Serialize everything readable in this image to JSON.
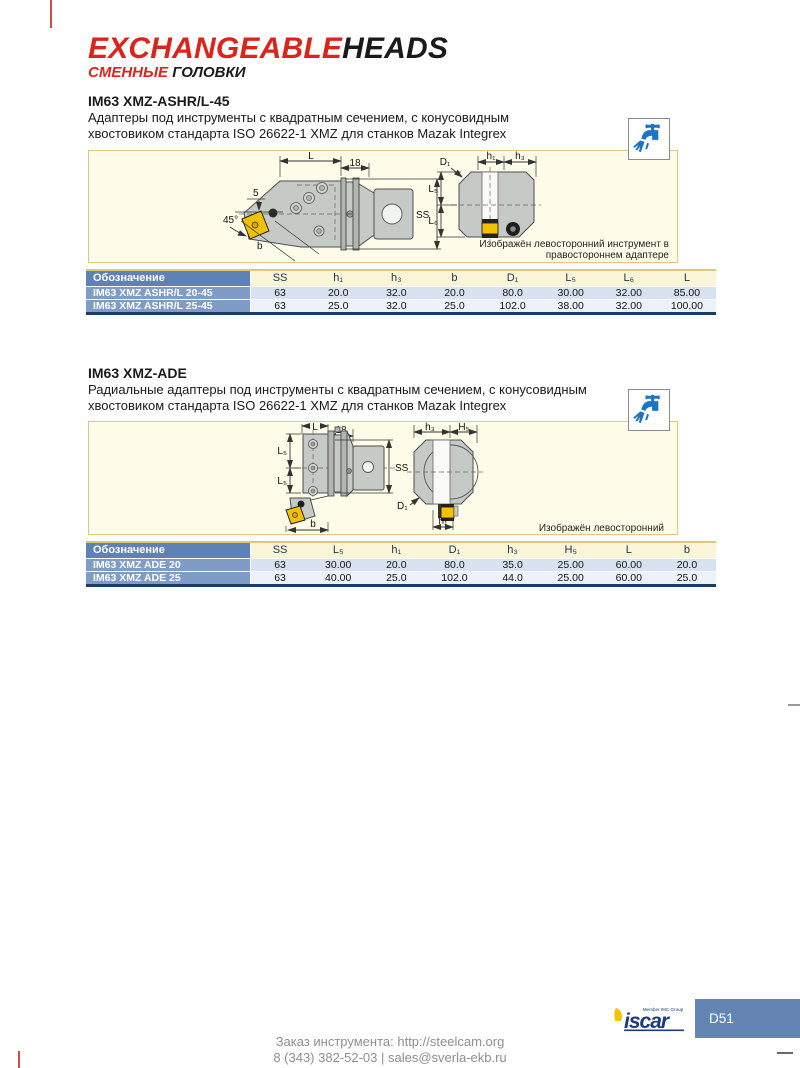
{
  "colors": {
    "accent_red": "#da251d",
    "table_header_blue": "#5d82b5",
    "row_name_blue": "#7e9cc6",
    "header_yellow": "#faf5d7",
    "row_light_blue": "#d9e2f0",
    "row_pale_blue": "#edf1f8",
    "navy_border": "#1e3a68",
    "panel_bg": "#fffdea",
    "panel_border": "#ddca7a",
    "coolant_icon_blue": "#1e74c4",
    "page_tab_blue": "#6484b4",
    "insert_yellow": "#f2c100"
  },
  "header": {
    "title_red": "EXCHANGEABLE",
    "title_black": "HEADS",
    "subtitle_red": "СМЕННЫЕ",
    "subtitle_black": "ГОЛОВКИ"
  },
  "sections": [
    {
      "title": "IM63 XMZ-ASHR/L-45",
      "desc1": "Адаптеры под инструменты с квадратным сечением, с конусовидным",
      "desc2": "хвостовиком стандарта ISO 26622-1 XMZ для станков Mazak Integrex",
      "diagram": {
        "labels": {
          "L": "L",
          "n18": "18",
          "n5": "5",
          "angle": "45°",
          "b": "b",
          "SS": "SS",
          "D1": "D₁",
          "h1": "h₁",
          "h3": "h₃",
          "L5": "L₅",
          "L6": "L₆"
        },
        "caption1": "Изображён левосторонний инструмент в",
        "caption2": "правостороннем адаптере"
      },
      "table": {
        "col0": "Обозначение",
        "cols": [
          "SS",
          "h₁",
          "h₃",
          "b",
          "D₁",
          "L₅",
          "L₆",
          "L"
        ],
        "rows": [
          {
            "name": "IM63 XMZ ASHR/L 20-45",
            "v": [
              "63",
              "20.0",
              "32.0",
              "20.0",
              "80.0",
              "30.00",
              "32.00",
              "85.00"
            ]
          },
          {
            "name": "IM63 XMZ ASHR/L 25-45",
            "v": [
              "63",
              "25.0",
              "32.0",
              "25.0",
              "102.0",
              "38.00",
              "32.00",
              "100.00"
            ]
          }
        ]
      }
    },
    {
      "title": "IM63 XMZ-ADE",
      "desc1": "Радиальные адаптеры под инструменты с квадратным сечением, с конусовидным",
      "desc2": "хвостовиком стандарта ISO 26622-1 XMZ для станков Mazak Integrex",
      "diagram": {
        "labels": {
          "L": "L",
          "n18": "18",
          "L5a": "L₅",
          "L5b": "L₅",
          "SS": "SS",
          "b": "b",
          "D1": "D₁",
          "h1": "h₁",
          "h3": "h₃",
          "H5": "H₅"
        },
        "caption1": "Изображён левосторонний"
      },
      "table": {
        "col0": "Обозначение",
        "cols": [
          "SS",
          "L₅",
          "h₁",
          "D₁",
          "h₃",
          "H₅",
          "L",
          "b"
        ],
        "rows": [
          {
            "name": "IM63 XMZ ADE 20",
            "v": [
              "63",
              "30.00",
              "20.0",
              "80.0",
              "35.0",
              "25.00",
              "60.00",
              "20.0"
            ]
          },
          {
            "name": "IM63 XMZ ADE 25",
            "v": [
              "63",
              "40.00",
              "25.0",
              "102.0",
              "44.0",
              "25.00",
              "60.00",
              "25.0"
            ]
          }
        ]
      }
    }
  ],
  "footer": {
    "order_line1": "Заказ инструмента: http://steelcam.org",
    "order_line2": "8 (343) 382-52-03  |  sales@sverla-ekb.ru",
    "page_number": "D51",
    "logo_caption": "Member IMC Group",
    "logo_text": "iscar"
  }
}
